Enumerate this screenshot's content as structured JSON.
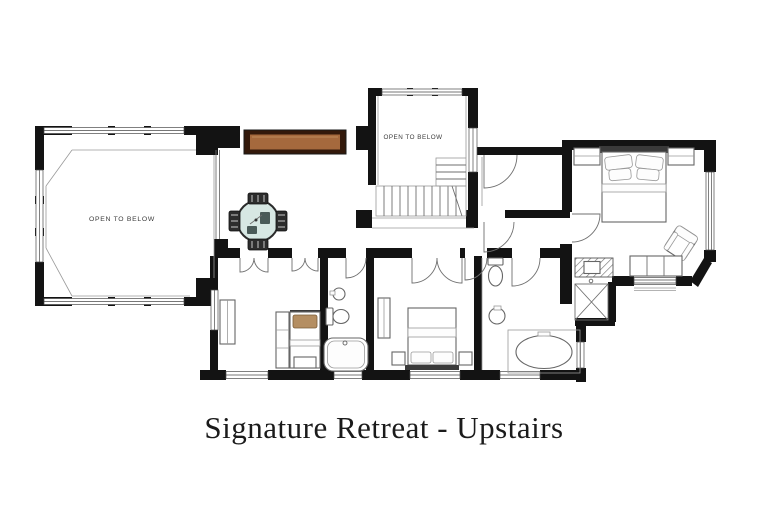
{
  "title": "Signature Retreat - Upstairs",
  "labels": {
    "open_to_below_main": "OPEN TO BELOW",
    "open_to_below_stairwell": "OPEN TO BELOW"
  },
  "colors": {
    "wall": "#131313",
    "wood_console": "#a5693d",
    "wood_console_border": "#33190b",
    "wood_highlight": "#c08a5a",
    "glass_table": "#d7e7e3",
    "pillow_tan": "#b48e62",
    "title_text": "#1b1b1b",
    "label_text": "#3a3a3a",
    "background": "#ffffff"
  }
}
